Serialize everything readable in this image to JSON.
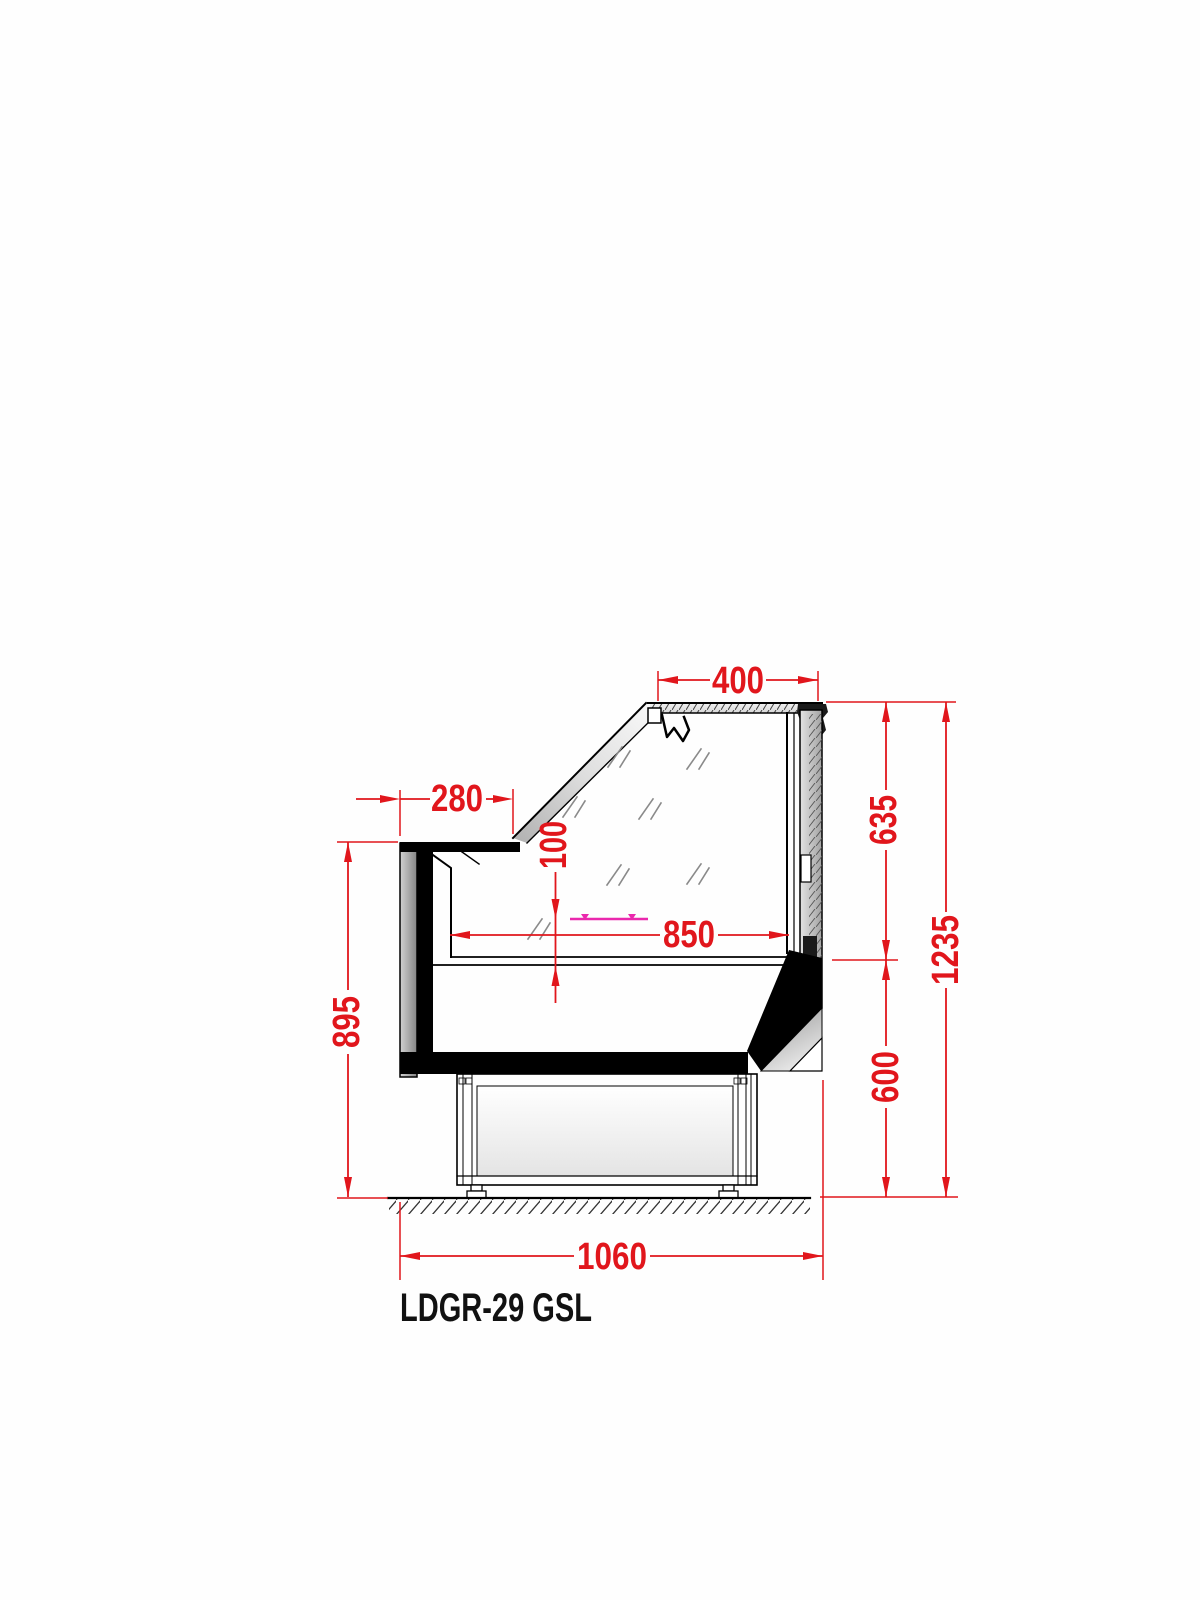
{
  "page": {
    "background": "#ffffff"
  },
  "drawing": {
    "model_label": "LDGR-29 GSL",
    "colors": {
      "dimension_red": "#e1161c",
      "shelf_magenta": "#ea28ad",
      "line_black": "#000000",
      "glass_reflection_gray": "#8a8a8a"
    },
    "dimensions": {
      "top_depth": "400",
      "front_ledge": "280",
      "deck_offset": "100",
      "display_depth": "850",
      "upper_height": "635",
      "total_height": "1235",
      "front_height": "895",
      "base_height": "600",
      "base_depth": "1060"
    }
  }
}
